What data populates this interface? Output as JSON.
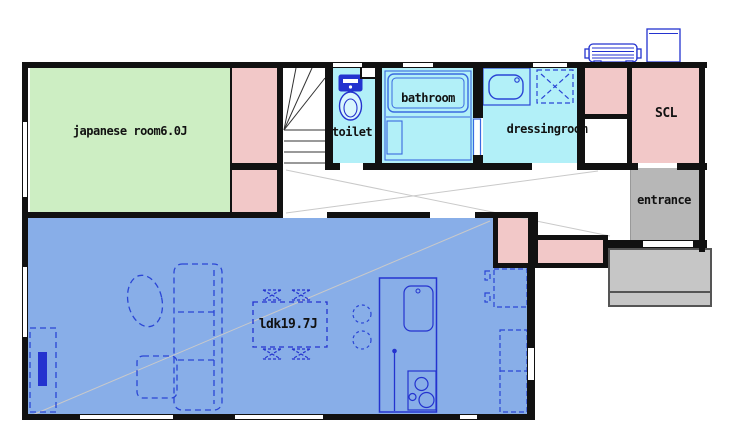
{
  "plan": {
    "rooms": {
      "japanese_room": {
        "label": "japanese room6.0J",
        "color": "#cdeec3"
      },
      "ldk": {
        "label": "ldk19.7J",
        "color": "#88aee8"
      },
      "toilet": {
        "label": "toilet",
        "color": "#b2f0f8"
      },
      "bathroom": {
        "label": "bathroom",
        "color": "#b2f0f8"
      },
      "dressingroom": {
        "label": "dressingroom",
        "color": "#b2f0f8"
      },
      "scl": {
        "label": "SCL",
        "color": "#f2c8c8"
      },
      "entrance": {
        "label": "entrance",
        "color": "#b7b7b7"
      }
    },
    "colors": {
      "wall": "#111111",
      "closet": "#f2c8c8",
      "fixture_line": "#2433cf",
      "porch": "#c6c6c6",
      "window": "#ffffff"
    },
    "fixtures": [
      "staircase",
      "toilet-seat",
      "bathtub",
      "wash-basin",
      "washing-machine",
      "kitchen-island",
      "kitchen-sink",
      "stove",
      "refrigerator",
      "kitchen-cabinet",
      "dining-table",
      "dining-chairs",
      "bar-stools",
      "sofa",
      "ottoman",
      "coffee-table",
      "tv-board",
      "heat-pump-unit",
      "water-tank"
    ]
  }
}
